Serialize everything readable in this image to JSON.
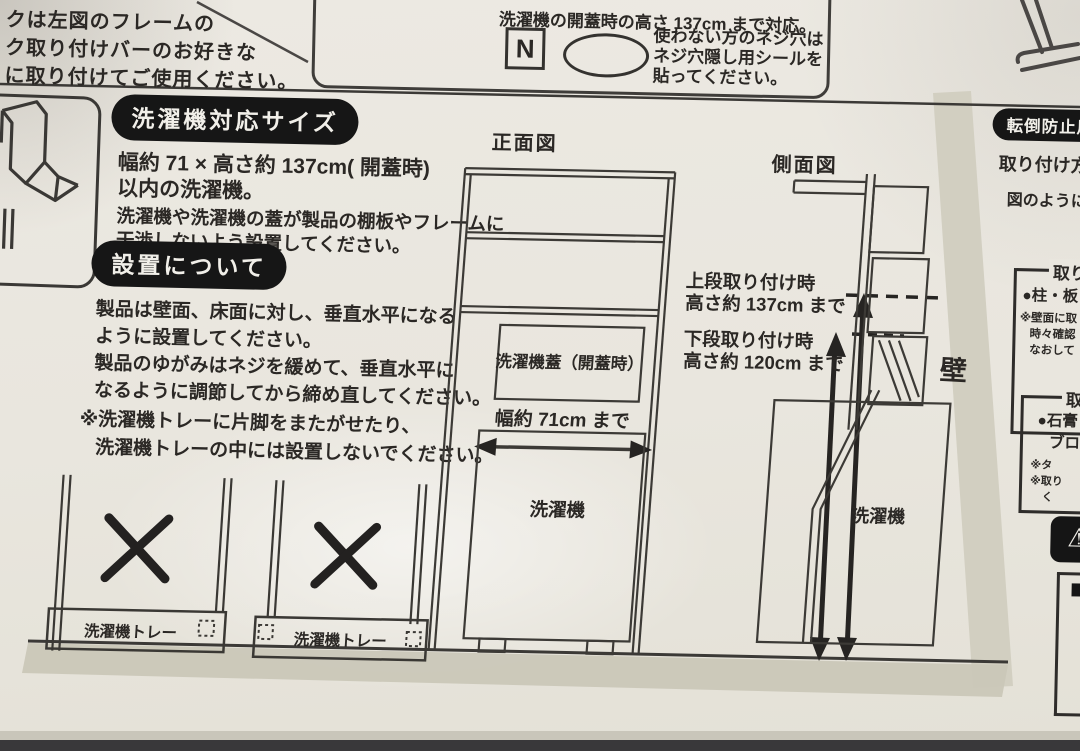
{
  "colors": {
    "paper": "#e9e6de",
    "ink": "#2b2825",
    "badge_bg": "#161616",
    "badge_text": "#f1efe9",
    "wall_shade": "#d2cfc1",
    "ground_shade": "#cac7b8",
    "background_dark": "#39383a"
  },
  "top_left_note": {
    "lines": [
      "クは左図のフレームの",
      "ク取り付けバーのお好きな",
      "に取り付けてご使用ください。"
    ]
  },
  "screw_box": {
    "line1": "洗濯機の開蓋時の高さ 137cm まで対応。",
    "n_label": "N",
    "note_lines": [
      "使わない方のネジ穴は",
      "ネジ穴隠し用シールを",
      "貼ってください。"
    ]
  },
  "size_section": {
    "badge": "洗濯機対応サイズ",
    "bold_line1": "幅約 71 × 高さ約 137cm( 開蓋時)",
    "bold_line2": "以内の洗濯機。",
    "line1": "洗濯機や洗濯機の蓋が製品の棚板やフレームに",
    "line2": "干渉しないよう設置してください。"
  },
  "install_section": {
    "badge": "設置について",
    "line1": "製品は壁面、床面に対し、垂直水平になる",
    "line2": "ように設置してください。",
    "line3": "製品のゆがみはネジを緩めて、垂直水平に",
    "line4": "なるように調節してから締め直してください。",
    "note1": "※洗濯機トレーに片脚をまたがせたり、",
    "note2": "洗濯機トレーの中には設置しないでください。"
  },
  "front_view": {
    "title": "正面図",
    "lid_label": "洗濯機蓋（開蓋時）",
    "width_label": "幅約 71cm まで",
    "machine_label": "洗濯機"
  },
  "side_view": {
    "title": "側面図",
    "upper_line1": "上段取り付け時",
    "upper_line2": "高さ約 137cm まで",
    "lower_line1": "下段取り付け時",
    "lower_line2": "高さ約 120cm まで",
    "machine_label": "洗濯機",
    "wall_label": "壁"
  },
  "tray_diagrams": {
    "label1": "洗濯機トレー",
    "label2": "洗濯機トレー"
  },
  "right_column": {
    "badge": "転倒防止用木ネ",
    "method_label": "取り付け方法",
    "figure_note": "図のように棚",
    "box1_header": "取り",
    "box1_lead": "●柱・板",
    "box1_note1": "※壁面に取",
    "box1_note2": "時々確認",
    "box1_note3": "なおして",
    "box2_header": "取",
    "box2_lead": "●石膏",
    "box2_lead2": "ブロ",
    "box2_note1": "※タ",
    "box2_note2": "※取り",
    "box2_note3": "く",
    "warning_icon": "⚠"
  }
}
